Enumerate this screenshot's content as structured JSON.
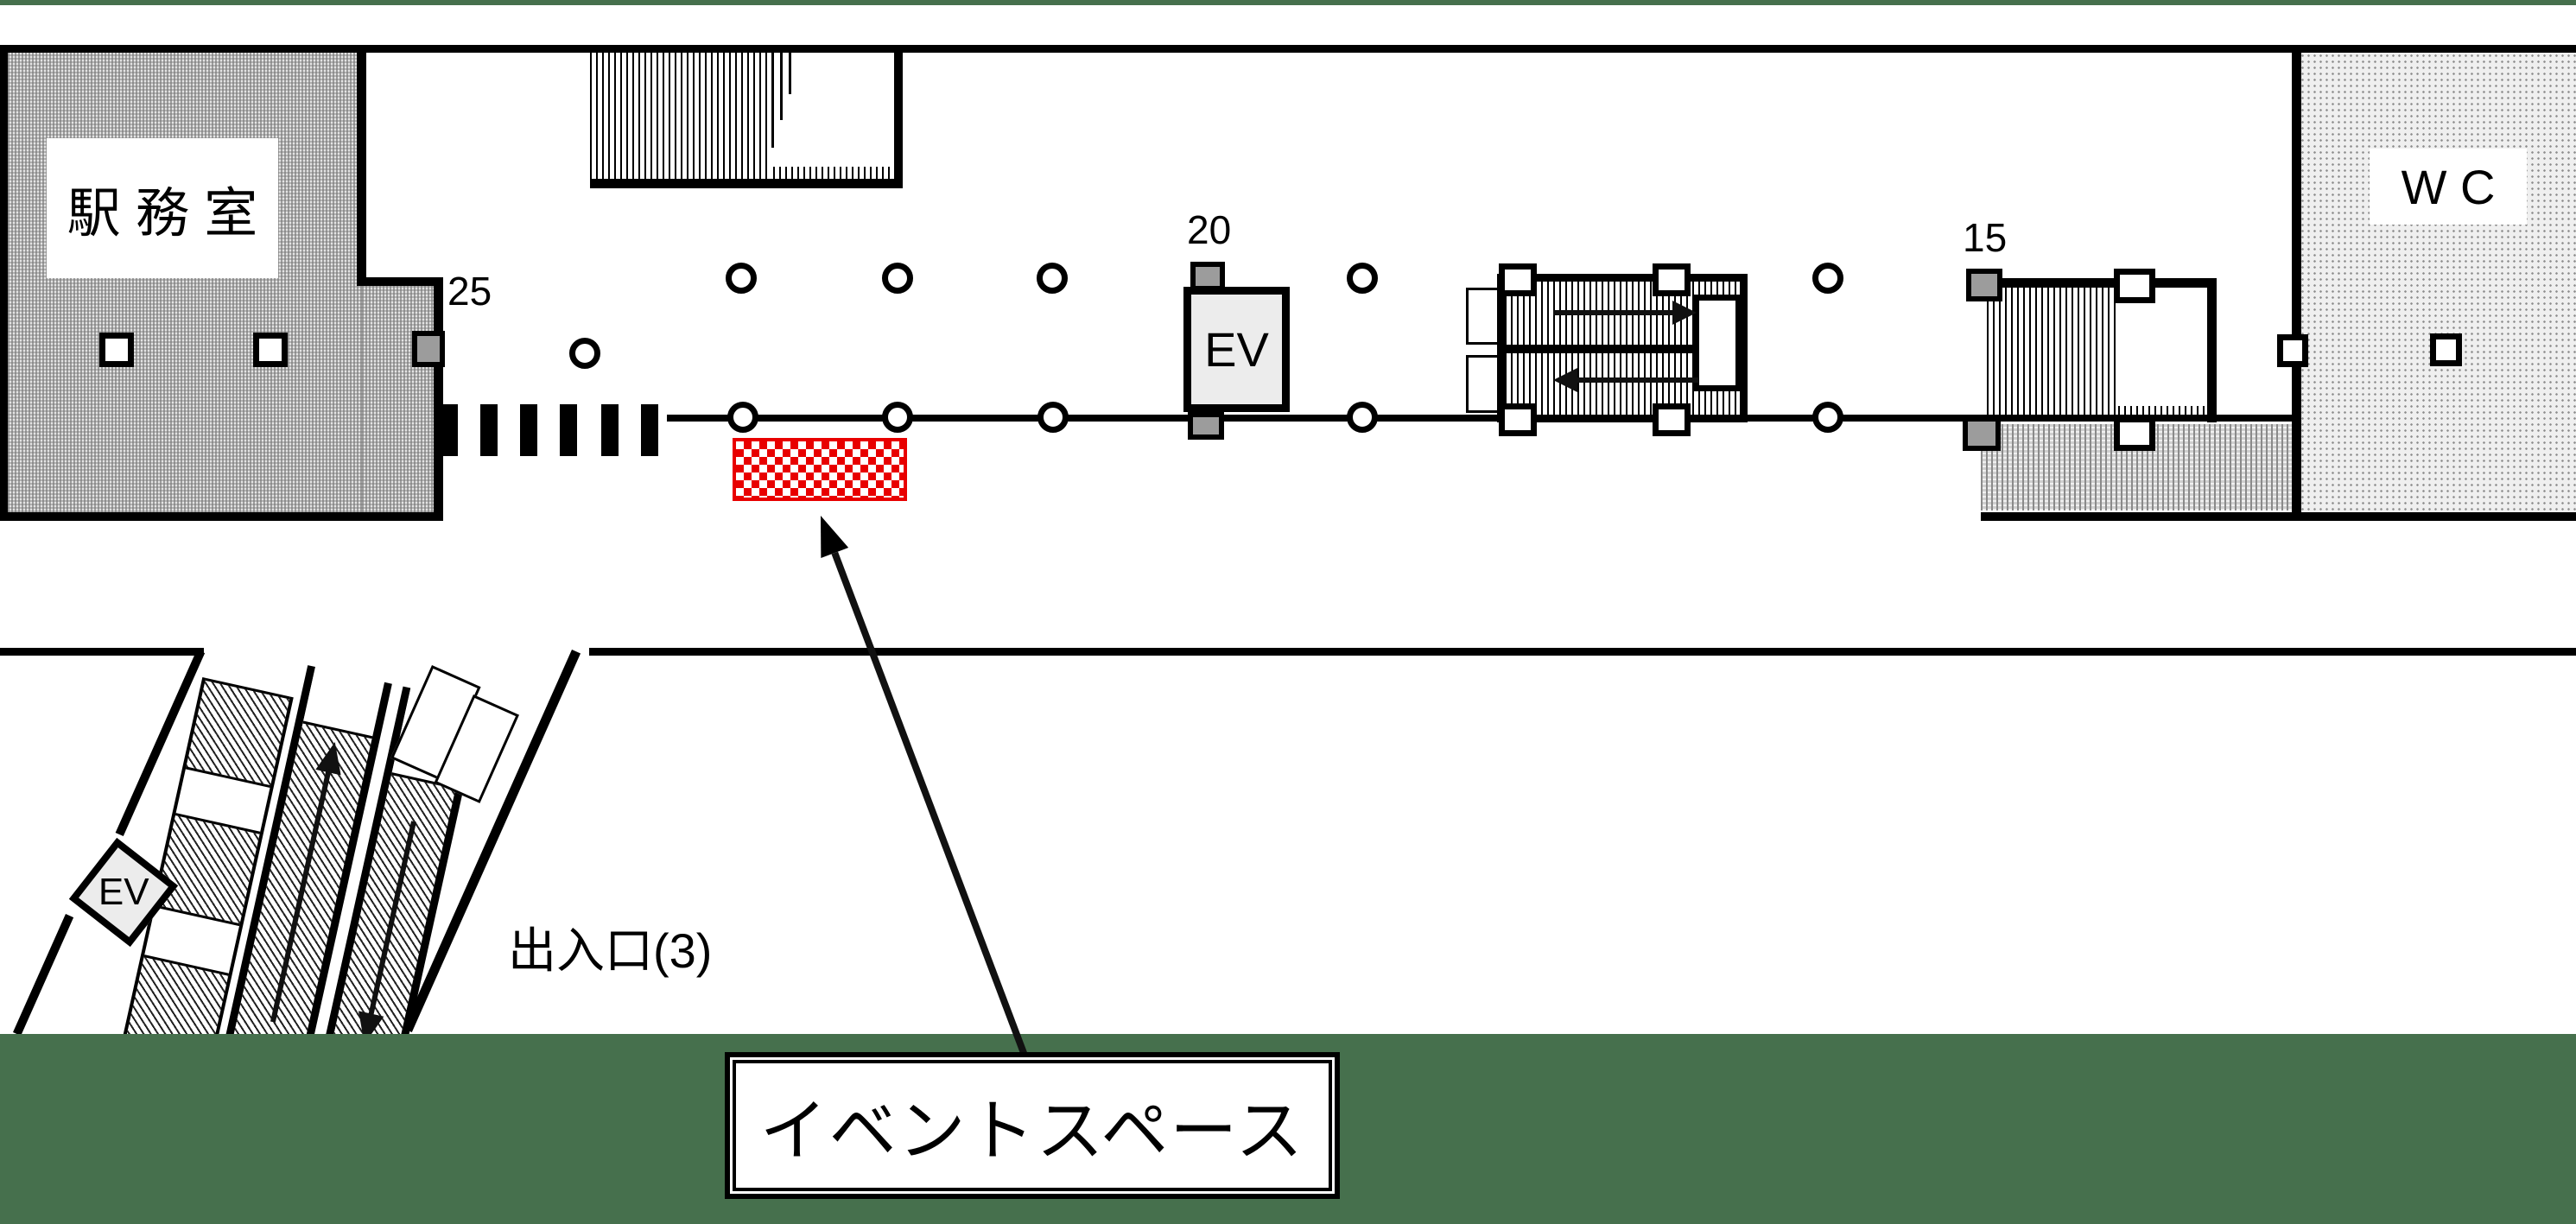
{
  "labels": {
    "station_office": "駅 務 室",
    "wc": "W C",
    "ev_center": "EV",
    "ev_lower": "EV",
    "pillar_25": "25",
    "pillar_20": "20",
    "pillar_15": "15",
    "exit": "出入口(3)",
    "event_space": "イベントスペース"
  },
  "colors": {
    "green": "#46704D",
    "red": "#e80000"
  },
  "legend": {
    "event_space_marker": "red-checker-rectangle",
    "escalator_up_arrow": "up",
    "escalator_down_arrow": "down",
    "walkway_arrows": [
      "right",
      "left"
    ]
  }
}
